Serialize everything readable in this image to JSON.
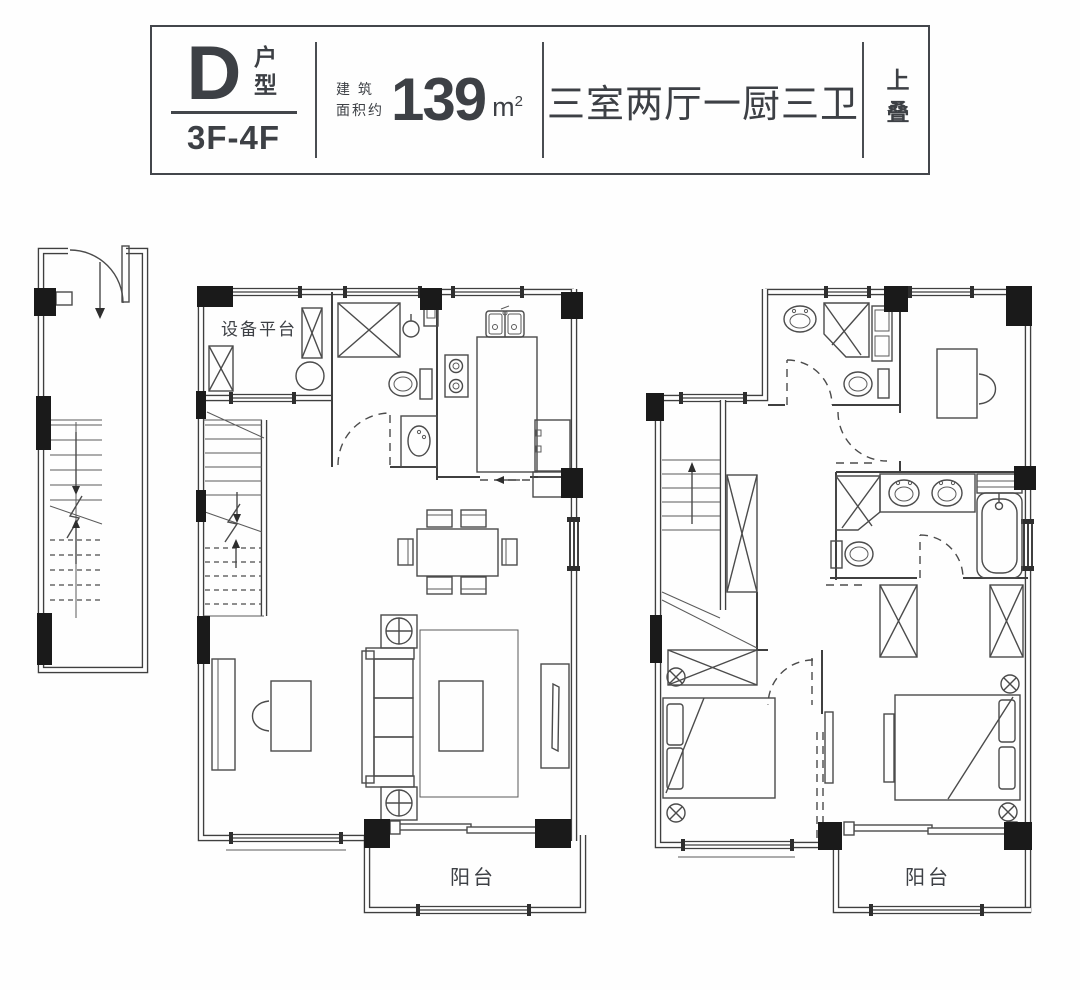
{
  "header": {
    "unit_letter": "D",
    "unit_type_label": "户型",
    "floor_range": "3F-4F",
    "area_label_line1": "建 筑",
    "area_label_line2": "面积约",
    "area_value": "139",
    "area_unit_base": "m",
    "area_unit_sup": "2",
    "room_config": "三室两厅一厨三卫",
    "position_tag": "上叠"
  },
  "plan_labels": {
    "equipment_platform": "设备平台",
    "balcony_lower": "阳台",
    "balcony_upper": "阳台"
  },
  "colors": {
    "line": "#3f3f3f",
    "column_fill": "#1a1a1a",
    "text": "#3d4045",
    "background": "#fefefe"
  }
}
